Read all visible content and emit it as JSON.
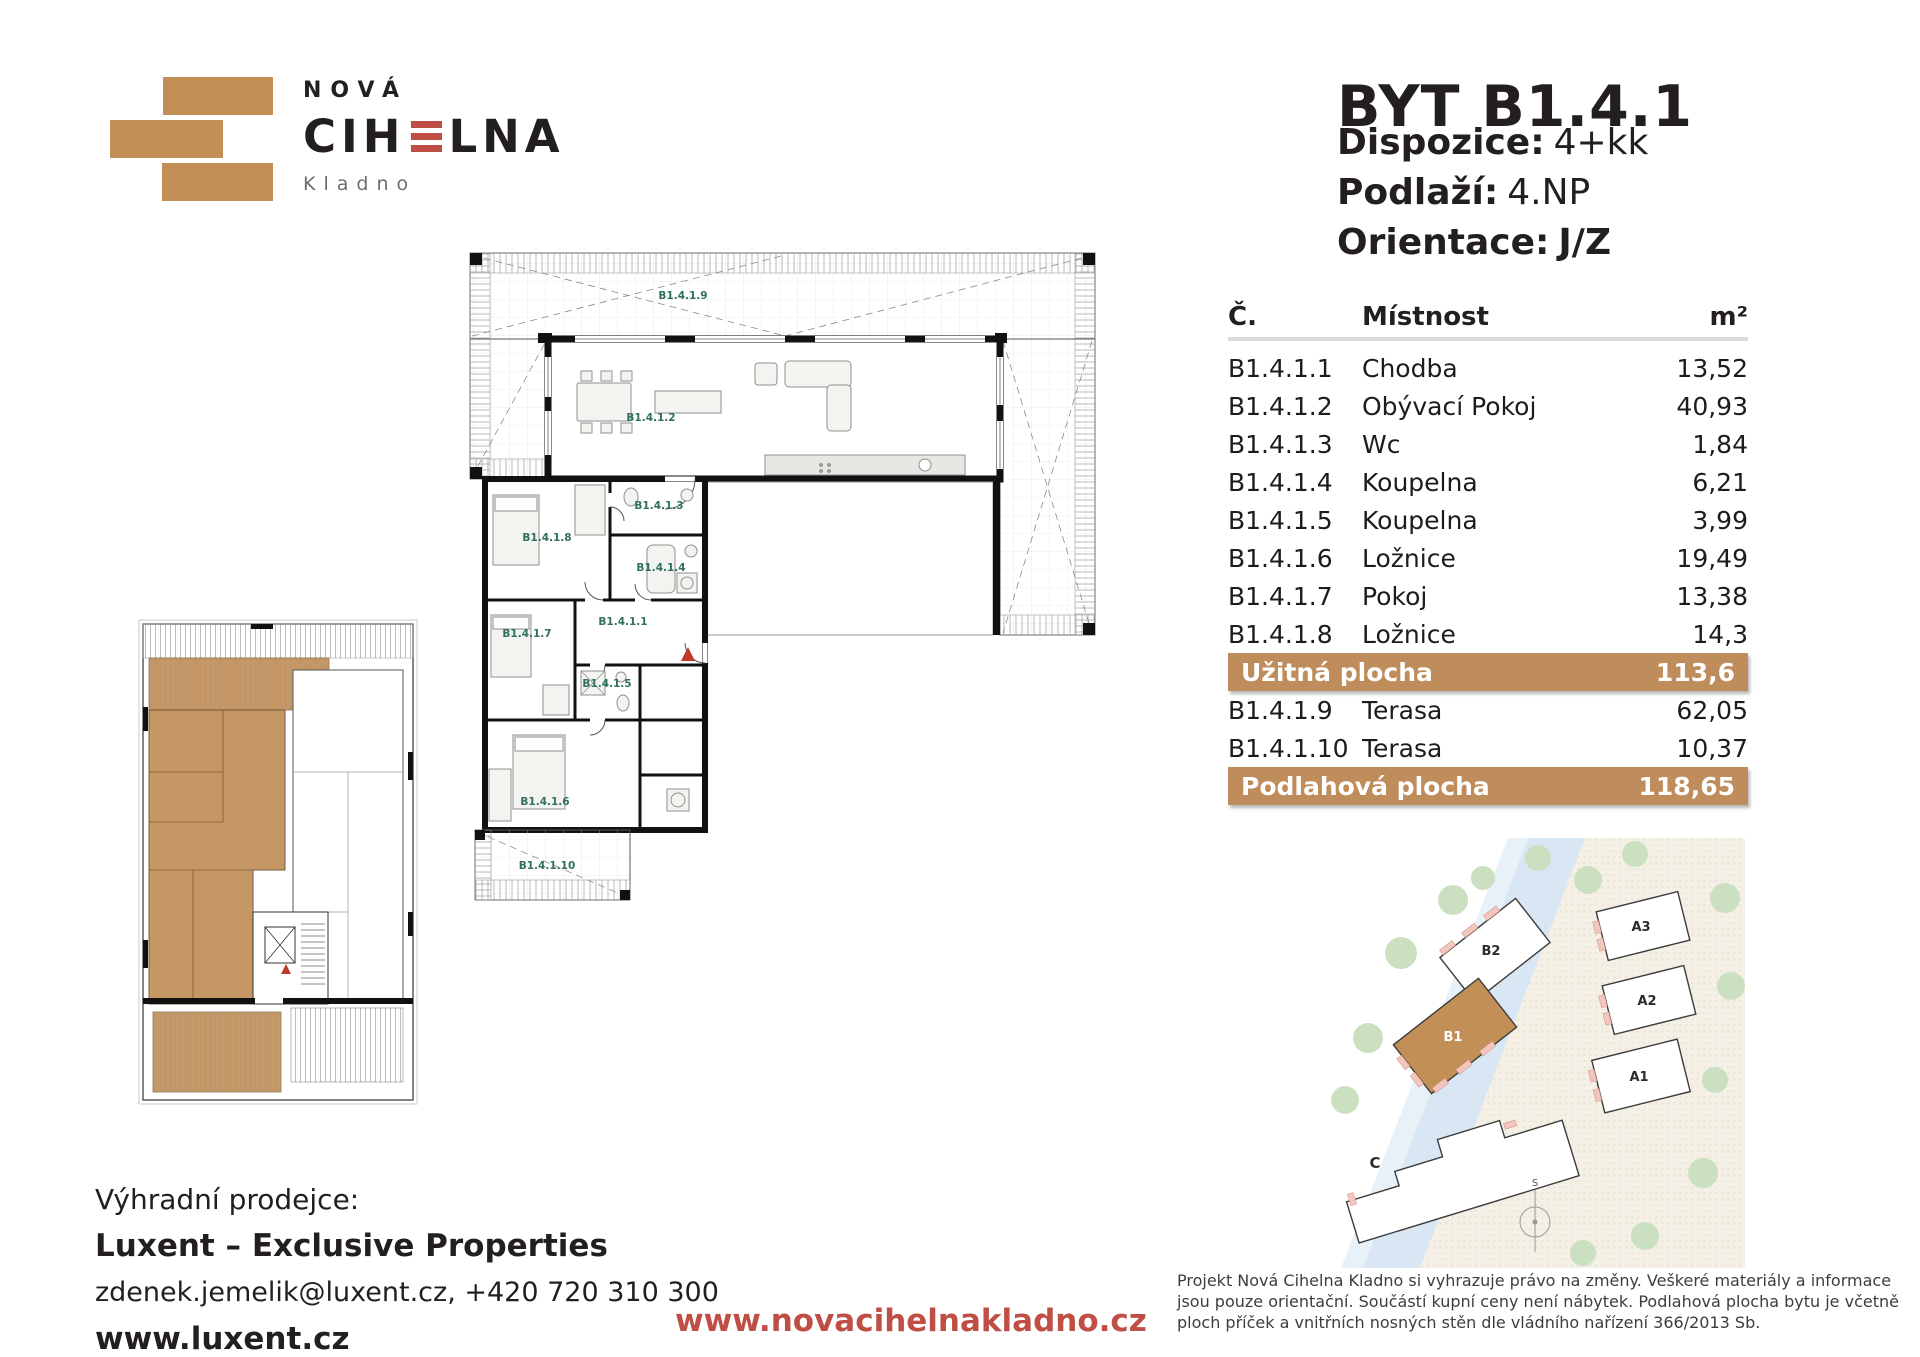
{
  "logo": {
    "line1": "NOVÁ",
    "brand_pre": "CIH",
    "brand_post": "LNA",
    "city": "Kladno"
  },
  "header": {
    "title": "BYT B1.4.1",
    "specs": [
      {
        "label": "Dispozice:",
        "value": "4+kk"
      },
      {
        "label": "Podlaží:",
        "value": "4.NP"
      },
      {
        "label": "Orientace:",
        "value": "J/Z"
      }
    ]
  },
  "table": {
    "col_code": "Č.",
    "col_room": "Místnost",
    "col_area": "m²",
    "rows": [
      {
        "code": "B1.4.1.1",
        "room": "Chodba",
        "area": "13,52"
      },
      {
        "code": "B1.4.1.2",
        "room": "Obývací Pokoj",
        "area": "40,93"
      },
      {
        "code": "B1.4.1.3",
        "room": "Wc",
        "area": "1,84"
      },
      {
        "code": "B1.4.1.4",
        "room": "Koupelna",
        "area": "6,21"
      },
      {
        "code": "B1.4.1.5",
        "room": "Koupelna",
        "area": "3,99"
      },
      {
        "code": "B1.4.1.6",
        "room": "Ložnice",
        "area": "19,49"
      },
      {
        "code": "B1.4.1.7",
        "room": "Pokoj",
        "area": "13,38"
      },
      {
        "code": "B1.4.1.8",
        "room": "Ložnice",
        "area": "14,3"
      }
    ],
    "usable": {
      "label": "Užitná plocha",
      "value": "113,6"
    },
    "terraces": [
      {
        "code": "B1.4.1.9",
        "room": "Terasa",
        "area": "62,05"
      },
      {
        "code": "B1.4.1.10",
        "room": "Terasa",
        "area": "10,37"
      }
    ],
    "floor_total": {
      "label": "Podlahová plocha",
      "value": "118,65"
    }
  },
  "floorplan": {
    "labels": [
      "B1.4.1.9",
      "B1.4.1.2",
      "B1.4.1.8",
      "B1.4.1.3",
      "B1.4.1.4",
      "B1.4.1.1",
      "B1.4.1.7",
      "B1.4.1.5",
      "B1.4.1.6",
      "B1.4.1.10"
    ]
  },
  "siteplan": {
    "buildings": [
      "B2",
      "B1",
      "A3",
      "A2",
      "A1",
      "C"
    ],
    "compass": "S"
  },
  "footer": {
    "seller_intro": "Výhradní prodejce:",
    "seller_name": "Luxent – Exclusive Properties",
    "seller_contact": "zdenek.jemelik@luxent.cz, +420 720 310 300",
    "seller_web": "www.luxent.cz",
    "project_web": "www.novacihelnakladno.cz",
    "disclaimer": "Projekt Nová Cihelna Kladno si vyhrazuje právo na změny. Veškeré materiály a informace jsou pouze orientační. Součástí kupní ceny není nábytek. Podlahová plocha bytu je včetně ploch příček a vnitřních nosných stěn dle vládního nařízení 366/2013 Sb."
  },
  "colors": {
    "brand_tan": "#C28F57",
    "brand_red": "#BF4E45",
    "table_band": "#BF8C5B",
    "room_label_teal": "#2F6F60"
  }
}
